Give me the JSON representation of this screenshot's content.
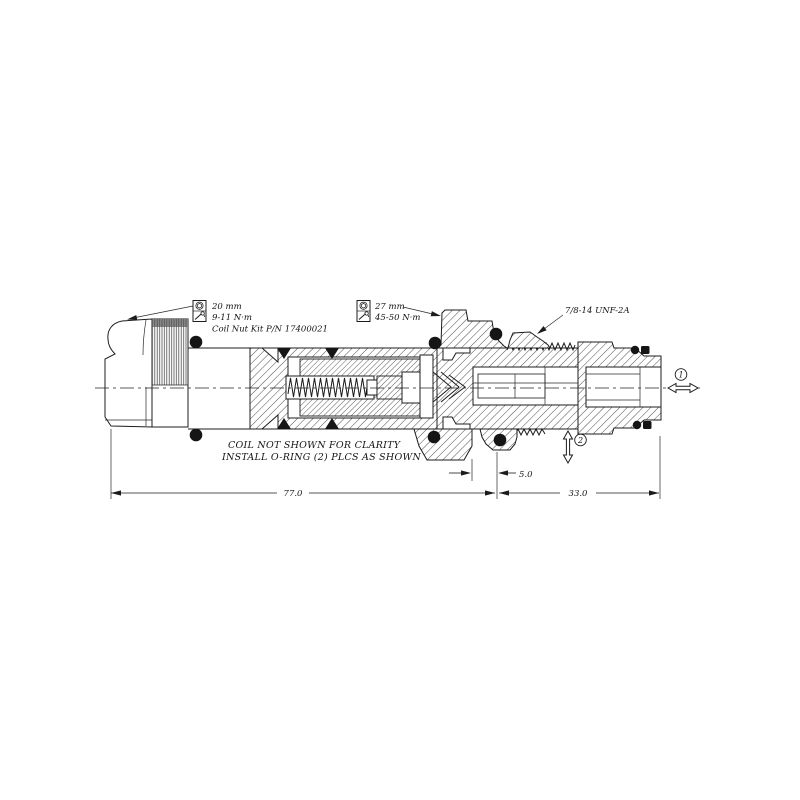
{
  "meta": {
    "type": "hydraulic cartridge valve cross-section drawing",
    "background": "#ffffff"
  },
  "callouts": {
    "coil_nut": {
      "wrench_size": "20 mm",
      "torque": "9-11 N·m",
      "kit_note": "Coil Nut Kit P/N 17400021",
      "socket_icon": "hex-socket",
      "torque_icon": "torque-wrench"
    },
    "valve_body": {
      "wrench_size": "27 mm",
      "torque": "45-50 N·m",
      "socket_icon": "hex-socket",
      "torque_icon": "torque-wrench"
    }
  },
  "thread_spec": "7/8-14 UNF-2A",
  "notes": {
    "line1": "COIL NOT SHOWN FOR CLARITY",
    "line2": "INSTALL O-RING (2) PLCS AS SHOWN"
  },
  "dimensions": {
    "overall_length": "77.0",
    "thread_end_length": "33.0",
    "seat_offset": "5.0"
  },
  "ports": {
    "port_1": "1",
    "port_2": "2"
  },
  "colors": {
    "line": "#1c1c1c",
    "hatch": "#3a3a3a",
    "oring": "#151515",
    "knurl_cap": "#8a8a8a"
  }
}
